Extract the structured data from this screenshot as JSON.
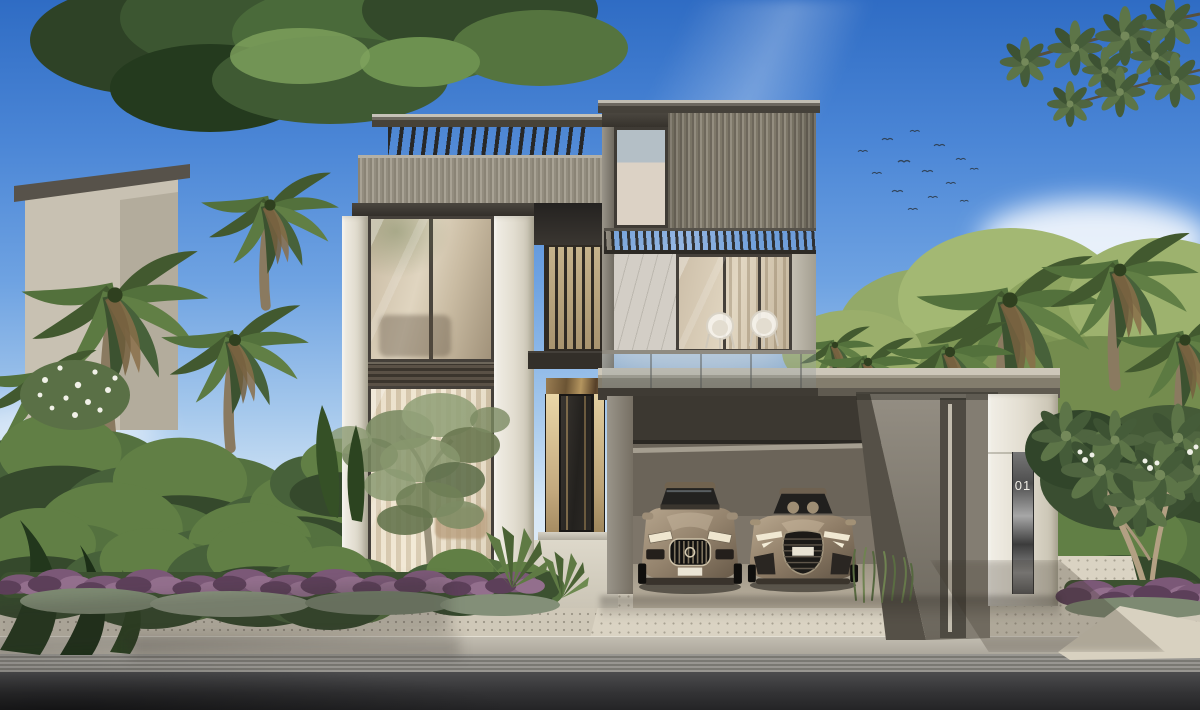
{
  "scene": {
    "description": "Daytime architectural rendering of a modern three-storey luxury villa with rooftop pergola, glass facade, balcony with two wicker chairs, carport with two bronze cars, palm garden, sidewalk and asphalt road",
    "time_of_day": "day"
  },
  "villa": {
    "unit_number": "01"
  },
  "colors": {
    "sky_top": "#2f6cc4",
    "sky_horizon": "#d8e8f6",
    "cloud_white": "#ffffff",
    "wall_cream": "#e6e1d4",
    "cladding_bronze": "#8b8577",
    "pergola_dark": "#35312b",
    "glass_warm": "#d8cab0",
    "glass_frame": "#45403a",
    "interior_glow": "#e8dcc2",
    "carport_wall": "#6e675c",
    "concrete_gray": "#8d887d",
    "metal_strip": "#5a5a5a",
    "car_bronze": "#9a8974",
    "paver": "#cfc8b8",
    "paver_light": "#dad3c3",
    "curb": "#b6b1a6",
    "gutter": "#8a8882",
    "road": "#333335",
    "foliage_dark": "#2e4425",
    "foliage_mid": "#4b6438",
    "foliage_light": "#6d8f4e",
    "flower_purple": "#7b5877",
    "flower_white": "#f1f1e8",
    "unit_number_color": "#efece4"
  }
}
